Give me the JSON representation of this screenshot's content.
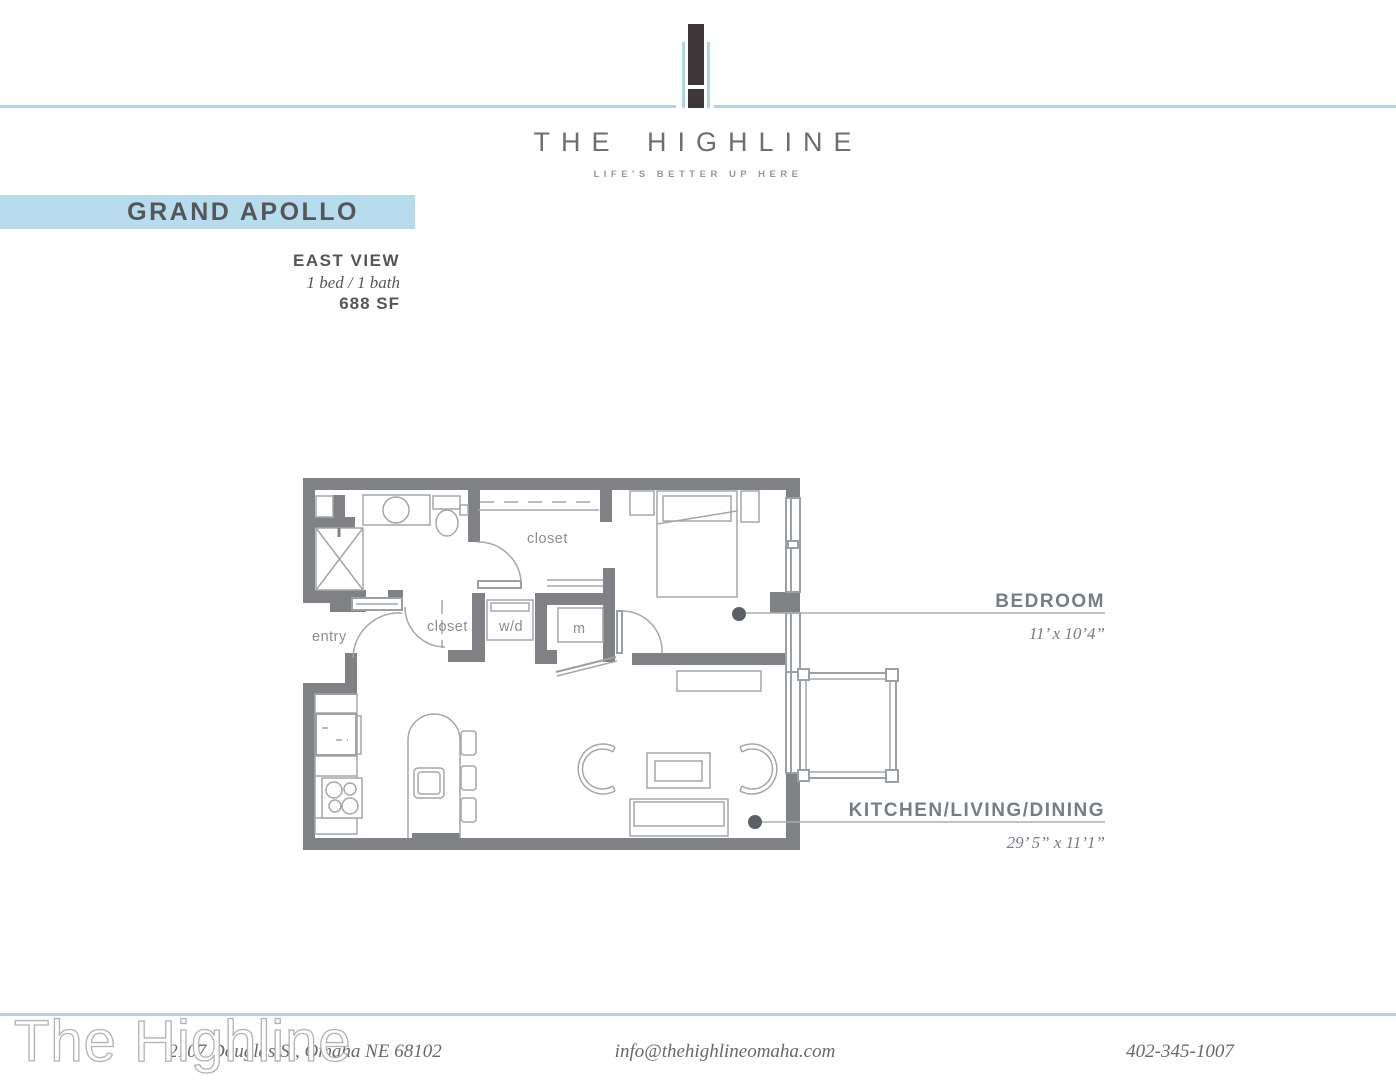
{
  "header": {
    "brand": "THE HIGHLINE",
    "tagline": "LIFE'S BETTER UP HERE"
  },
  "plan": {
    "name": "GRAND APOLLO",
    "view": "EAST VIEW",
    "config": "1 bed / 1 bath",
    "area": "688 SF"
  },
  "floorplan": {
    "room_labels": {
      "entry": "entry",
      "closet_upper": "closet",
      "closet_lower": "closet",
      "washer_dryer": "w/d",
      "mechanical": "m"
    },
    "callouts": [
      {
        "label": "BEDROOM",
        "dimensions": "11’ x 10’4”"
      },
      {
        "label": "KITCHEN/LIVING/DINING",
        "dimensions": "29’ 5” x 11’1”"
      }
    ]
  },
  "watermark": "The Highline",
  "footer": {
    "address": "2107 Douglas St, Omaha NE 68102",
    "email": "info@thehighlineomaha.com",
    "phone": "402-345-1007"
  },
  "colors": {
    "accent_blue": "#aed6e9",
    "banner_blue": "#b7dcee",
    "wall_gray": "#808184",
    "callout_gray": "#767d84",
    "title_gray": "#54565a",
    "logo_dark": "#3d3739"
  }
}
